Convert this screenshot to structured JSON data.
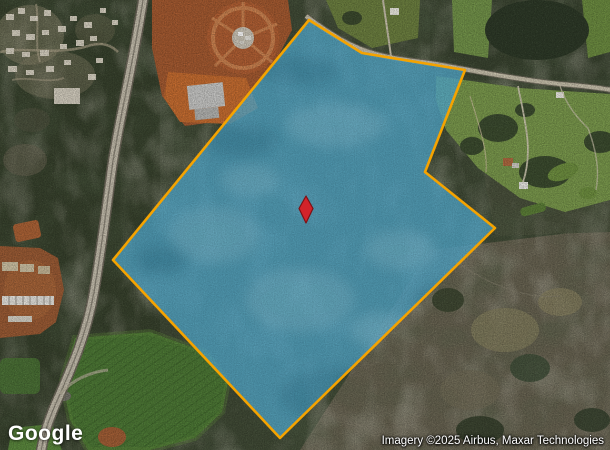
{
  "branding": {
    "logo_text": "Google"
  },
  "attribution": {
    "text": "Imagery ©2025 Airbus, Maxar Technologies"
  },
  "parcel": {
    "points": "309,20 362,53 465,70 425,172 495,228 280,438 113,260",
    "fill_color": "#53A7C9",
    "fill_opacity": "0.8",
    "stroke_color": "#F5A300",
    "stroke_width": "2.6"
  },
  "marker": {
    "path": "M306,196 L313,208.5 L306,223 L299,208.5 Z",
    "fill_color": "#D2232A",
    "stroke_color": "#7E1014"
  }
}
